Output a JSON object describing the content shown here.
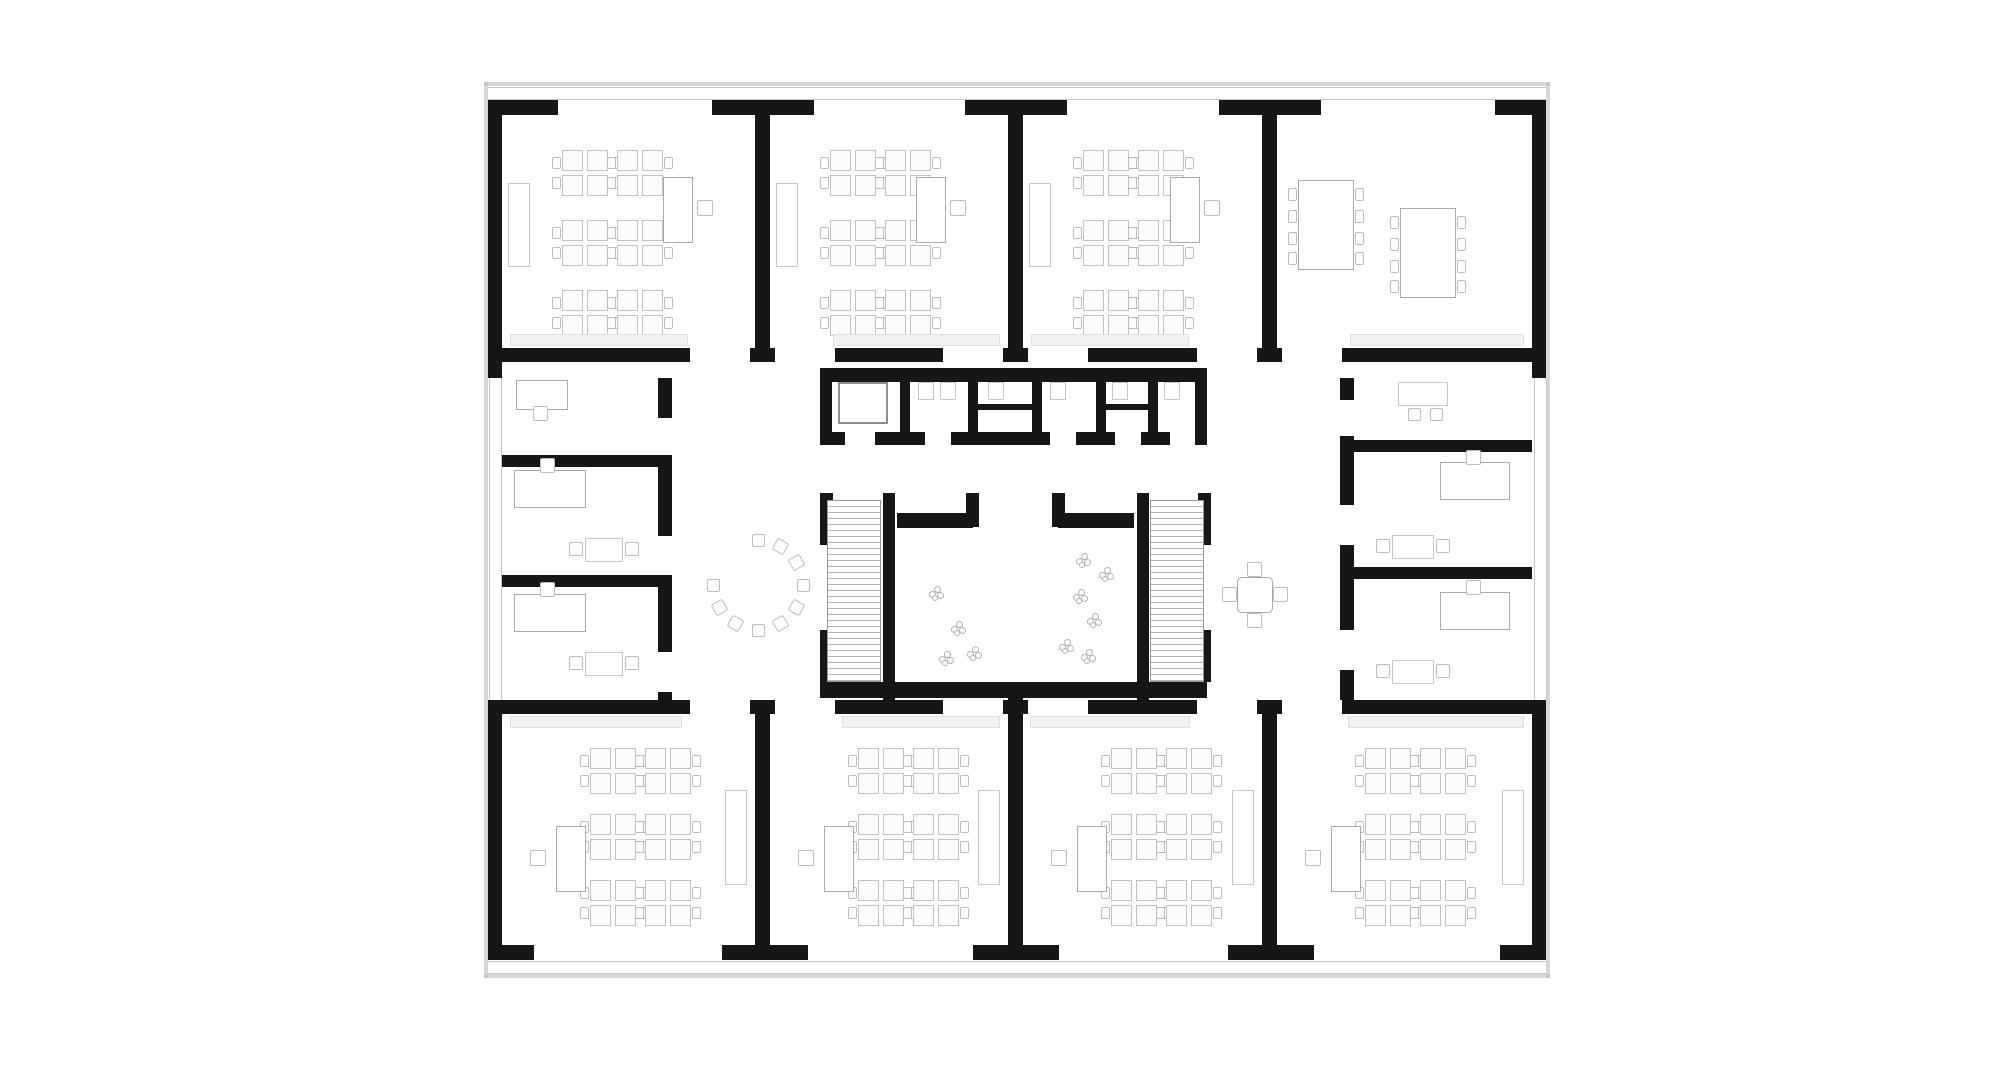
{
  "canvas": {
    "width": 2000,
    "height": 1079,
    "background": "#ffffff"
  },
  "palette": {
    "wall": "#161616",
    "window_line": "#c6c6c6",
    "furniture_line_light": "#c7c7c7",
    "furniture_line_mid": "#a9a9a9",
    "stair_tread": "#b2b2b2",
    "sill_fill": "#f2f2f2",
    "shadow": "#bdbdbd",
    "floor": "#ffffff"
  },
  "shadow": [
    [
      484,
      82,
      1066,
      4
    ],
    [
      484,
      974,
      1066,
      4
    ],
    [
      484,
      82,
      4,
      896
    ],
    [
      1546,
      82,
      4,
      896
    ]
  ],
  "windows": [
    {
      "x": 488,
      "y": 87,
      "w": 1058,
      "h": 13,
      "o": "h"
    },
    {
      "x": 488,
      "y": 961,
      "w": 1058,
      "h": 13,
      "o": "h"
    },
    {
      "x": 489,
      "y": 378,
      "w": 13,
      "h": 322,
      "o": "v"
    },
    {
      "x": 1534,
      "y": 378,
      "w": 13,
      "h": 322,
      "o": "v"
    }
  ],
  "walls": [
    [
      488,
      100,
      70,
      15
    ],
    [
      712,
      100,
      102,
      15
    ],
    [
      965,
      100,
      102,
      15
    ],
    [
      1219,
      100,
      102,
      15
    ],
    [
      1495,
      100,
      51,
      15
    ],
    [
      488,
      945,
      46,
      15
    ],
    [
      722,
      945,
      86,
      15
    ],
    [
      973,
      945,
      86,
      15
    ],
    [
      1228,
      945,
      86,
      15
    ],
    [
      1500,
      945,
      46,
      15
    ],
    [
      488,
      100,
      14,
      278
    ],
    [
      488,
      700,
      14,
      260
    ],
    [
      1532,
      100,
      14,
      278
    ],
    [
      1532,
      700,
      14,
      260
    ],
    [
      755,
      100,
      15,
      262
    ],
    [
      1008,
      100,
      15,
      262
    ],
    [
      1262,
      100,
      15,
      262
    ],
    [
      755,
      714,
      15,
      231
    ],
    [
      1008,
      714,
      15,
      231
    ],
    [
      1262,
      714,
      15,
      231
    ],
    [
      502,
      348,
      188,
      14
    ],
    [
      750,
      348,
      25,
      14
    ],
    [
      835,
      348,
      108,
      14
    ],
    [
      1003,
      348,
      25,
      14
    ],
    [
      1088,
      348,
      109,
      14
    ],
    [
      1257,
      348,
      25,
      14
    ],
    [
      1342,
      348,
      190,
      14
    ],
    [
      502,
      700,
      188,
      14
    ],
    [
      750,
      700,
      25,
      14
    ],
    [
      835,
      700,
      108,
      14
    ],
    [
      1003,
      700,
      25,
      14
    ],
    [
      1088,
      700,
      109,
      14
    ],
    [
      1257,
      700,
      25,
      14
    ],
    [
      1342,
      700,
      190,
      14
    ],
    [
      658,
      378,
      14,
      40
    ],
    [
      658,
      458,
      14,
      78
    ],
    [
      658,
      576,
      14,
      76
    ],
    [
      658,
      692,
      14,
      8
    ],
    [
      502,
      455,
      170,
      12
    ],
    [
      502,
      575,
      170,
      12
    ],
    [
      1340,
      378,
      14,
      22
    ],
    [
      1340,
      436,
      14,
      69
    ],
    [
      1340,
      545,
      14,
      85
    ],
    [
      1340,
      670,
      14,
      30
    ],
    [
      1340,
      440,
      192,
      12
    ],
    [
      1340,
      567,
      192,
      12
    ],
    [
      820,
      368,
      387,
      14
    ],
    [
      820,
      368,
      12,
      77
    ],
    [
      1195,
      368,
      12,
      77
    ],
    [
      820,
      432,
      25,
      13
    ],
    [
      875,
      432,
      50,
      13
    ],
    [
      951,
      432,
      99,
      13
    ],
    [
      1076,
      432,
      39,
      13
    ],
    [
      1141,
      432,
      29,
      13
    ],
    [
      1196,
      432,
      11,
      13
    ],
    [
      900,
      368,
      10,
      64
    ],
    [
      968,
      368,
      10,
      64
    ],
    [
      1032,
      368,
      10,
      64
    ],
    [
      1096,
      368,
      10,
      64
    ],
    [
      1148,
      368,
      10,
      64
    ],
    [
      978,
      404,
      54,
      6
    ],
    [
      1106,
      404,
      42,
      6
    ],
    [
      883,
      493,
      12,
      207
    ],
    [
      1137,
      493,
      12,
      207
    ],
    [
      897,
      513,
      76,
      15
    ],
    [
      966,
      493,
      13,
      34
    ],
    [
      1058,
      513,
      76,
      15
    ],
    [
      1052,
      493,
      13,
      34
    ],
    [
      820,
      493,
      13,
      52
    ],
    [
      820,
      630,
      13,
      52
    ],
    [
      1198,
      493,
      13,
      52
    ],
    [
      1198,
      630,
      13,
      52
    ],
    [
      820,
      682,
      387,
      16
    ],
    [
      1008,
      682,
      15,
      32
    ]
  ],
  "stairs": [
    {
      "x": 827,
      "y": 500,
      "w": 54,
      "h": 182
    },
    {
      "x": 1150,
      "y": 500,
      "w": 54,
      "h": 182
    }
  ],
  "furniture": [
    {
      "t": "cluster",
      "x": 562,
      "y": 150
    },
    {
      "t": "cluster",
      "x": 617,
      "y": 150
    },
    {
      "t": "cluster",
      "x": 562,
      "y": 220
    },
    {
      "t": "cluster",
      "x": 617,
      "y": 220
    },
    {
      "t": "cluster",
      "x": 562,
      "y": 290
    },
    {
      "t": "cluster",
      "x": 617,
      "y": 290
    },
    {
      "t": "cluster",
      "x": 830,
      "y": 150
    },
    {
      "t": "cluster",
      "x": 885,
      "y": 150
    },
    {
      "t": "cluster",
      "x": 830,
      "y": 220
    },
    {
      "t": "cluster",
      "x": 885,
      "y": 220
    },
    {
      "t": "cluster",
      "x": 830,
      "y": 290
    },
    {
      "t": "cluster",
      "x": 885,
      "y": 290
    },
    {
      "t": "cluster",
      "x": 1083,
      "y": 150
    },
    {
      "t": "cluster",
      "x": 1138,
      "y": 150
    },
    {
      "t": "cluster",
      "x": 1083,
      "y": 220
    },
    {
      "t": "cluster",
      "x": 1138,
      "y": 220
    },
    {
      "t": "cluster",
      "x": 1083,
      "y": 290
    },
    {
      "t": "cluster",
      "x": 1138,
      "y": 290
    },
    {
      "t": "cluster",
      "x": 590,
      "y": 748
    },
    {
      "t": "cluster",
      "x": 645,
      "y": 748
    },
    {
      "t": "cluster",
      "x": 590,
      "y": 814
    },
    {
      "t": "cluster",
      "x": 645,
      "y": 814
    },
    {
      "t": "cluster",
      "x": 590,
      "y": 880
    },
    {
      "t": "cluster",
      "x": 645,
      "y": 880
    },
    {
      "t": "cluster",
      "x": 858,
      "y": 748
    },
    {
      "t": "cluster",
      "x": 913,
      "y": 748
    },
    {
      "t": "cluster",
      "x": 858,
      "y": 814
    },
    {
      "t": "cluster",
      "x": 913,
      "y": 814
    },
    {
      "t": "cluster",
      "x": 858,
      "y": 880
    },
    {
      "t": "cluster",
      "x": 913,
      "y": 880
    },
    {
      "t": "cluster",
      "x": 1111,
      "y": 748
    },
    {
      "t": "cluster",
      "x": 1166,
      "y": 748
    },
    {
      "t": "cluster",
      "x": 1111,
      "y": 814
    },
    {
      "t": "cluster",
      "x": 1166,
      "y": 814
    },
    {
      "t": "cluster",
      "x": 1111,
      "y": 880
    },
    {
      "t": "cluster",
      "x": 1166,
      "y": 880
    },
    {
      "t": "cluster",
      "x": 1365,
      "y": 748
    },
    {
      "t": "cluster",
      "x": 1420,
      "y": 748
    },
    {
      "t": "cluster",
      "x": 1365,
      "y": 814
    },
    {
      "t": "cluster",
      "x": 1420,
      "y": 814
    },
    {
      "t": "cluster",
      "x": 1365,
      "y": 880
    },
    {
      "t": "cluster",
      "x": 1420,
      "y": 880
    },
    {
      "t": "rect",
      "name": "teacher-desk",
      "cls": "mid",
      "x": 663,
      "y": 177,
      "w": 30,
      "h": 66
    },
    {
      "t": "rect",
      "name": "teacher-desk",
      "cls": "mid",
      "x": 916,
      "y": 177,
      "w": 30,
      "h": 66
    },
    {
      "t": "rect",
      "name": "teacher-desk",
      "cls": "mid",
      "x": 1170,
      "y": 177,
      "w": 30,
      "h": 66
    },
    {
      "t": "chair",
      "x": 697,
      "y": 200,
      "s": 16
    },
    {
      "t": "chair",
      "x": 950,
      "y": 200,
      "s": 16
    },
    {
      "t": "chair",
      "x": 1204,
      "y": 200,
      "s": 16
    },
    {
      "t": "rect",
      "name": "teacher-desk",
      "cls": "mid",
      "x": 556,
      "y": 826,
      "w": 30,
      "h": 66
    },
    {
      "t": "rect",
      "name": "teacher-desk",
      "cls": "mid",
      "x": 824,
      "y": 826,
      "w": 30,
      "h": 66
    },
    {
      "t": "rect",
      "name": "teacher-desk",
      "cls": "mid",
      "x": 1077,
      "y": 826,
      "w": 30,
      "h": 66
    },
    {
      "t": "rect",
      "name": "teacher-desk",
      "cls": "mid",
      "x": 1331,
      "y": 826,
      "w": 30,
      "h": 66
    },
    {
      "t": "chair",
      "x": 530,
      "y": 850,
      "s": 16
    },
    {
      "t": "chair",
      "x": 798,
      "y": 850,
      "s": 16
    },
    {
      "t": "chair",
      "x": 1051,
      "y": 850,
      "s": 16
    },
    {
      "t": "chair",
      "x": 1305,
      "y": 850,
      "s": 16
    },
    {
      "t": "rect",
      "name": "cabinet",
      "cls": "light",
      "x": 508,
      "y": 183,
      "w": 22,
      "h": 84
    },
    {
      "t": "rect",
      "name": "cabinet",
      "cls": "light",
      "x": 776,
      "y": 183,
      "w": 22,
      "h": 84
    },
    {
      "t": "rect",
      "name": "cabinet",
      "cls": "light",
      "x": 1029,
      "y": 183,
      "w": 22,
      "h": 84
    },
    {
      "t": "rect",
      "name": "cabinet",
      "cls": "light",
      "x": 725,
      "y": 790,
      "w": 22,
      "h": 95
    },
    {
      "t": "rect",
      "name": "cabinet",
      "cls": "light",
      "x": 978,
      "y": 790,
      "w": 22,
      "h": 95
    },
    {
      "t": "rect",
      "name": "cabinet",
      "cls": "light",
      "x": 1232,
      "y": 790,
      "w": 22,
      "h": 95
    },
    {
      "t": "rect",
      "name": "cabinet",
      "cls": "light",
      "x": 1502,
      "y": 790,
      "w": 22,
      "h": 95
    },
    {
      "t": "sill",
      "x": 510,
      "y": 334,
      "w": 178
    },
    {
      "t": "sill",
      "x": 833,
      "y": 334,
      "w": 167
    },
    {
      "t": "sill",
      "x": 1031,
      "y": 334,
      "w": 158
    },
    {
      "t": "sill",
      "x": 1350,
      "y": 334,
      "w": 174
    },
    {
      "t": "sill",
      "x": 510,
      "y": 716,
      "w": 172
    },
    {
      "t": "sill",
      "x": 842,
      "y": 716,
      "w": 158
    },
    {
      "t": "sill",
      "x": 1030,
      "y": 716,
      "w": 160
    },
    {
      "t": "sill",
      "x": 1348,
      "y": 716,
      "w": 176
    },
    {
      "t": "bigtable",
      "x": 1288,
      "y": 180
    },
    {
      "t": "bigtable",
      "x": 1390,
      "y": 208
    },
    {
      "t": "rect",
      "name": "office-desk",
      "cls": "mid",
      "x": 516,
      "y": 380,
      "w": 52,
      "h": 30
    },
    {
      "t": "chair",
      "x": 533,
      "y": 406,
      "s": 15
    },
    {
      "t": "rect",
      "name": "office-desk",
      "cls": "mid",
      "x": 514,
      "y": 470,
      "w": 72,
      "h": 38
    },
    {
      "t": "chair",
      "x": 540,
      "y": 458,
      "s": 15
    },
    {
      "t": "rect",
      "name": "meeting-table",
      "cls": "light",
      "x": 585,
      "y": 538,
      "w": 38,
      "h": 24
    },
    {
      "t": "chair",
      "x": 569,
      "y": 542,
      "s": 14
    },
    {
      "t": "chair",
      "x": 625,
      "y": 542,
      "s": 14
    },
    {
      "t": "rect",
      "name": "office-desk",
      "cls": "mid",
      "x": 514,
      "y": 594,
      "w": 72,
      "h": 38
    },
    {
      "t": "chair",
      "x": 540,
      "y": 582,
      "s": 15
    },
    {
      "t": "rect",
      "name": "meeting-table",
      "cls": "light",
      "x": 585,
      "y": 652,
      "w": 38,
      "h": 24
    },
    {
      "t": "chair",
      "x": 569,
      "y": 656,
      "s": 14
    },
    {
      "t": "chair",
      "x": 625,
      "y": 656,
      "s": 14
    },
    {
      "t": "rect",
      "name": "meeting-table",
      "cls": "light",
      "x": 1398,
      "y": 382,
      "w": 50,
      "h": 24
    },
    {
      "t": "chair",
      "x": 1408,
      "y": 408,
      "s": 13
    },
    {
      "t": "chair",
      "x": 1430,
      "y": 408,
      "s": 13
    },
    {
      "t": "rect",
      "name": "office-desk",
      "cls": "mid",
      "x": 1440,
      "y": 462,
      "w": 70,
      "h": 38
    },
    {
      "t": "chair",
      "x": 1466,
      "y": 450,
      "s": 15
    },
    {
      "t": "rect",
      "name": "meeting-table",
      "cls": "light",
      "x": 1392,
      "y": 535,
      "w": 42,
      "h": 24
    },
    {
      "t": "chair",
      "x": 1376,
      "y": 539,
      "s": 14
    },
    {
      "t": "chair",
      "x": 1436,
      "y": 539,
      "s": 14
    },
    {
      "t": "rect",
      "name": "office-desk",
      "cls": "mid",
      "x": 1440,
      "y": 592,
      "w": 70,
      "h": 38
    },
    {
      "t": "chair",
      "x": 1466,
      "y": 580,
      "s": 15
    },
    {
      "t": "rect",
      "name": "meeting-table",
      "cls": "light",
      "x": 1392,
      "y": 660,
      "w": 42,
      "h": 24
    },
    {
      "t": "chair",
      "x": 1376,
      "y": 664,
      "s": 14
    },
    {
      "t": "chair",
      "x": 1436,
      "y": 664,
      "s": 14
    },
    {
      "t": "rect",
      "name": "elevator-car",
      "cls": "elev",
      "x": 838,
      "y": 382,
      "w": 50,
      "h": 42
    },
    {
      "t": "rect",
      "name": "wc-fixture",
      "cls": "light",
      "x": 918,
      "y": 382,
      "w": 16,
      "h": 18
    },
    {
      "t": "rect",
      "name": "wc-fixture",
      "cls": "light",
      "x": 940,
      "y": 382,
      "w": 16,
      "h": 18
    },
    {
      "t": "rect",
      "name": "wc-fixture",
      "cls": "light",
      "x": 988,
      "y": 382,
      "w": 16,
      "h": 18
    },
    {
      "t": "rect",
      "name": "wc-fixture",
      "cls": "light",
      "x": 1050,
      "y": 382,
      "w": 16,
      "h": 18
    },
    {
      "t": "rect",
      "name": "wc-fixture",
      "cls": "light",
      "x": 1112,
      "y": 382,
      "w": 16,
      "h": 18
    },
    {
      "t": "rect",
      "name": "wc-fixture",
      "cls": "light",
      "x": 1164,
      "y": 382,
      "w": 16,
      "h": 18
    },
    {
      "t": "arc",
      "cx": 758,
      "cy": 585,
      "r": 45,
      "n": 10,
      "a0": -90,
      "a1": 180
    },
    {
      "t": "rtable",
      "x": 1222,
      "y": 562
    },
    {
      "t": "plant",
      "x": 928,
      "y": 585
    },
    {
      "t": "plant",
      "x": 950,
      "y": 620
    },
    {
      "t": "plant",
      "x": 966,
      "y": 645
    },
    {
      "t": "plant",
      "x": 938,
      "y": 650
    },
    {
      "t": "plant",
      "x": 1075,
      "y": 552
    },
    {
      "t": "plant",
      "x": 1098,
      "y": 566
    },
    {
      "t": "plant",
      "x": 1072,
      "y": 588
    },
    {
      "t": "plant",
      "x": 1086,
      "y": 612
    },
    {
      "t": "plant",
      "x": 1058,
      "y": 638
    },
    {
      "t": "plant",
      "x": 1080,
      "y": 648
    }
  ]
}
